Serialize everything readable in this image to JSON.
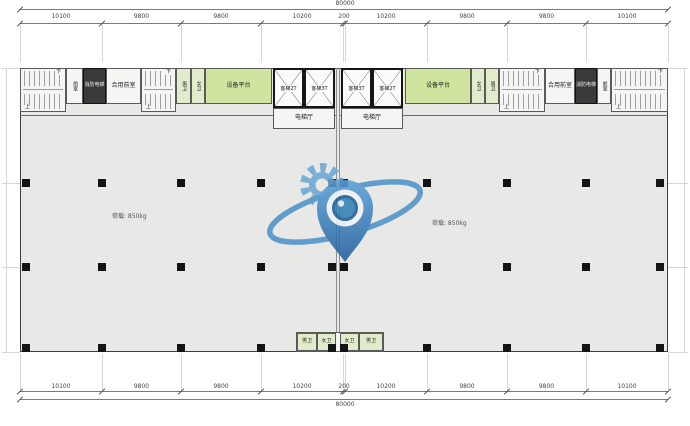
{
  "dimensions": {
    "overall_top": "80000",
    "overall_bottom": "80000",
    "top_segments": [
      "10100",
      "9800",
      "9800",
      "10200",
      "200",
      "10200",
      "9800",
      "9800",
      "10100"
    ],
    "bottom_segments": [
      "10100",
      "9800",
      "9800",
      "10200",
      "200",
      "10200",
      "9800",
      "9800",
      "10100"
    ]
  },
  "rooms": {
    "equipment_platform": "设备平台",
    "elevator_hall": "电梯厅",
    "fire_elevator": "消防电梯",
    "shared_anteroom": "合用前室",
    "anteroom": "前室",
    "male_toilet": "男卫",
    "female_toilet": "女卫",
    "elevators": [
      "客梯2T",
      "客梯3T",
      "客梯3T",
      "客梯2T"
    ]
  },
  "stairs": {
    "down": "下",
    "up": "上"
  },
  "notes": {
    "load_left": "荷载: 850kg",
    "load_right": "荷载: 850kg"
  },
  "watermark": {
    "icon": "eye-location-pin-logo",
    "primary": "#4a90c8",
    "dark": "#215f9e",
    "light": "#6ca6d3"
  },
  "colors": {
    "floor": "#e8e9e6",
    "equipment_green": "#cfe49e",
    "toilet_green": "#e0ecca",
    "wall": "#4a4a4a"
  }
}
